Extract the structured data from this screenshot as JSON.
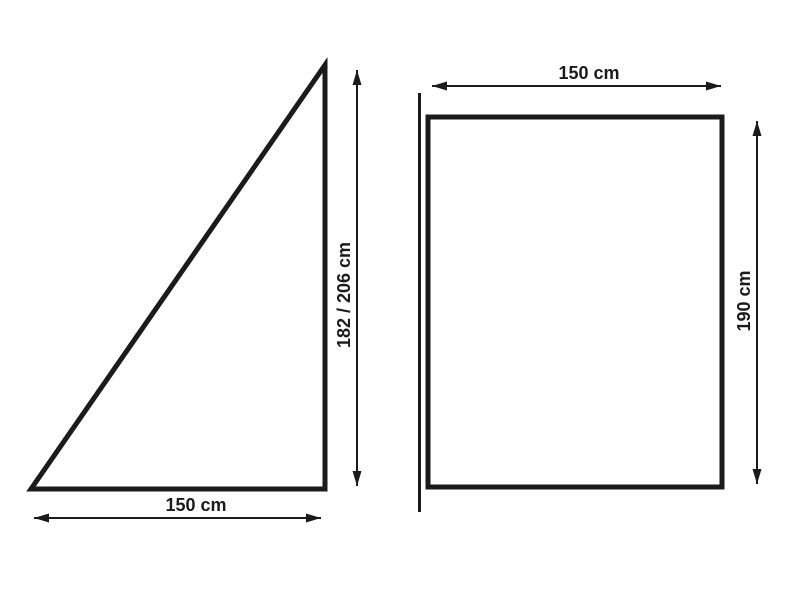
{
  "diagram": {
    "type": "dimension-drawing",
    "background_color": "#ffffff",
    "line_color": "#1b1b1b",
    "left_figure": {
      "shape": "right-triangle",
      "height_label": "182 / 206 cm",
      "base_label": "150 cm"
    },
    "right_figure": {
      "shape": "rectangle",
      "width_label": "150 cm",
      "height_label": "190 cm"
    }
  }
}
